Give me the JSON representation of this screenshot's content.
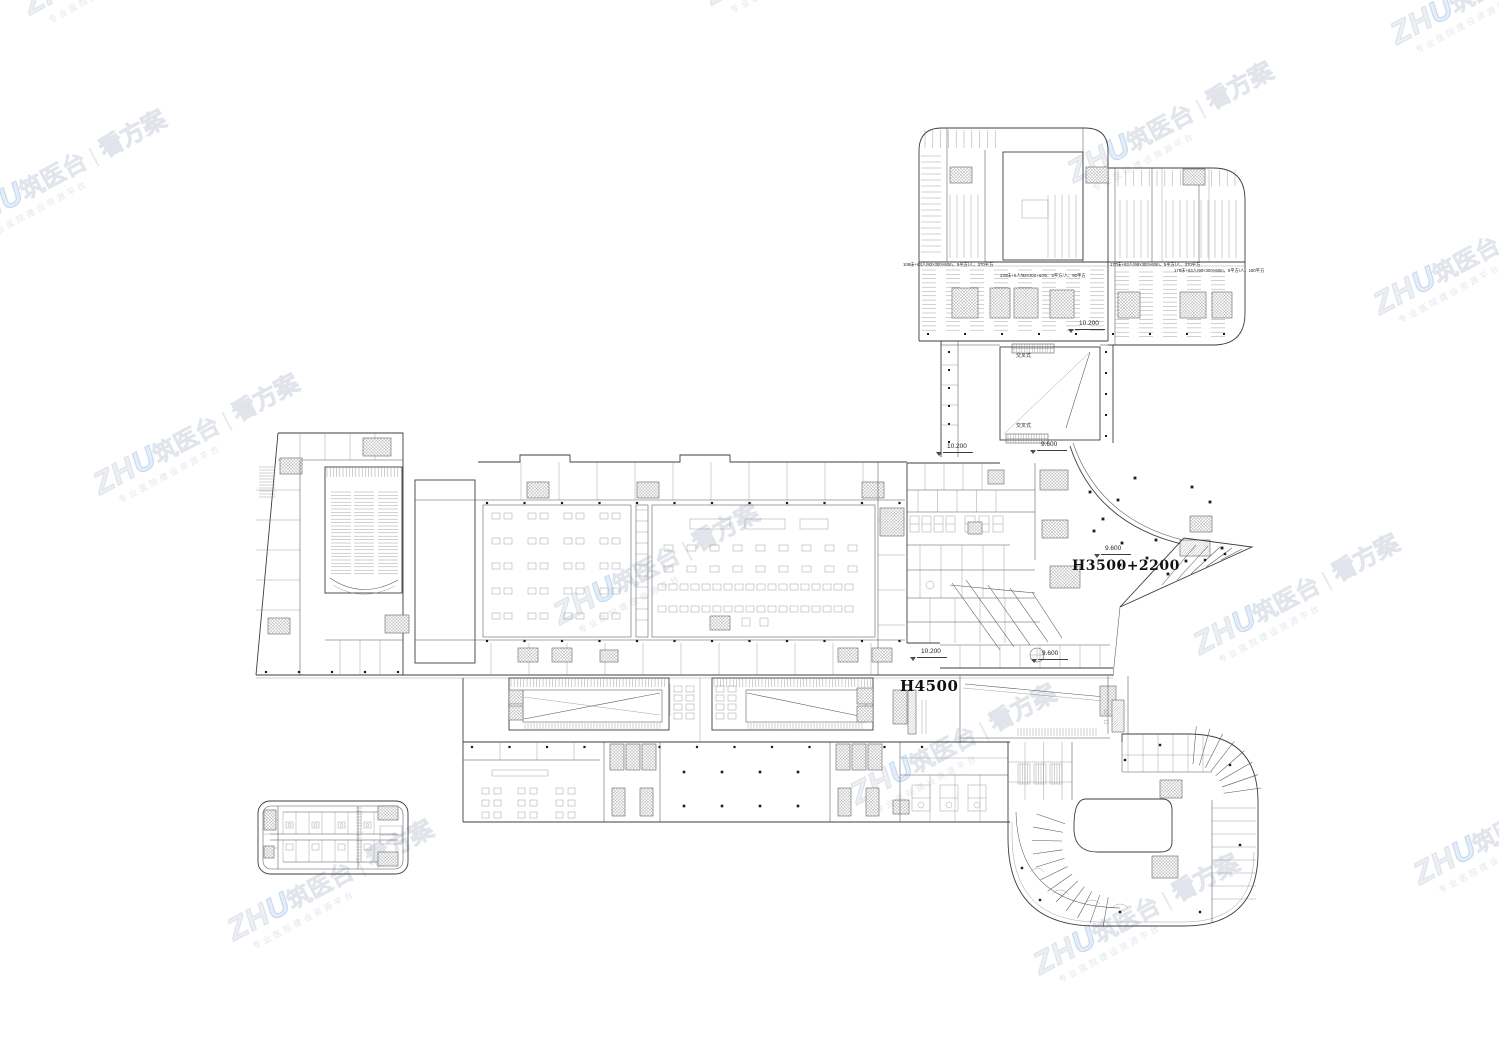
{
  "page": {
    "background": "#ffffff",
    "line_color": "#3e3e3e"
  },
  "watermark": {
    "brand_latin": "ZH",
    "brand_u": "U",
    "brand_cn": "筑医台",
    "separator": "|",
    "suffix": "看方案",
    "tagline": "专业医院建设资源平台",
    "gray": "#d3d8e1",
    "blue": "#96bbe6"
  },
  "drawing": {
    "labels": {
      "h4500": "H4500",
      "h3500": "H3500+2200",
      "lev_10200": "10.200",
      "lev_9600": "9.600",
      "escalator": "交叉式"
    },
    "annotations": [
      "108床+63人/90×300×60m、5平方/人、370平方",
      "230床+6人/9a×300×60m、5平方/人、90平方",
      "177床+63人/98×300×60m、5平方/人、370平方",
      "178床+63人/98×300×60m、5平方/人、180平方"
    ]
  }
}
